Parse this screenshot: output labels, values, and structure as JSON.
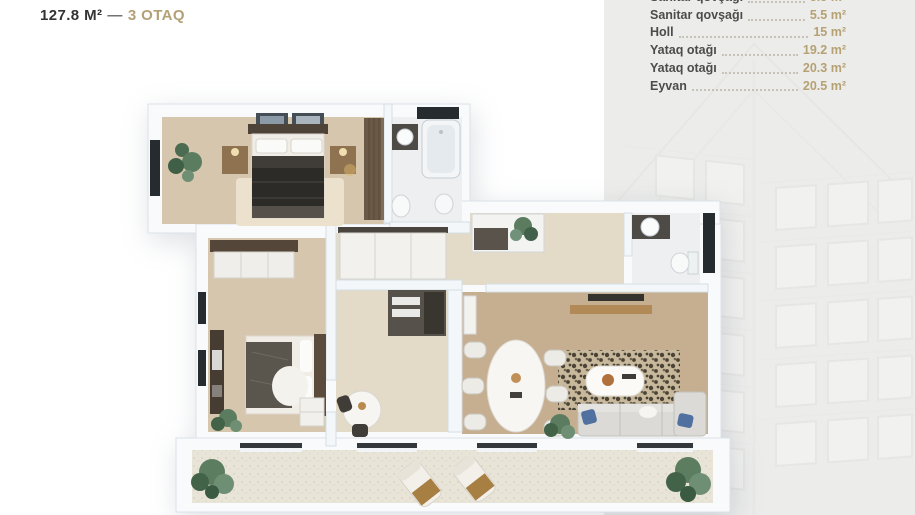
{
  "header": {
    "area": "127.8 M²",
    "separator": "—",
    "rooms": "3 OTAQ"
  },
  "room_list": {
    "rows": [
      {
        "label": "Sanitar qovşağı",
        "value": "5.5 m²",
        "truncated": true
      },
      {
        "label": "Sanitar qovşağı",
        "value": "5.5 m²"
      },
      {
        "label": "Holl",
        "value": "15 m²"
      },
      {
        "label": "Yataq otağı",
        "value": "19.2 m²"
      },
      {
        "label": "Yataq otağı",
        "value": "20.3 m²"
      },
      {
        "label": "Eyvan",
        "value": "20.5 m²"
      }
    ]
  },
  "colors": {
    "accent_gold": "#b3a077",
    "text_dark": "#333333",
    "list_label": "#4c4c4c",
    "panel_bg": "#ececeb",
    "wall_white": "#f8fafc",
    "floor_bedroom": "#d7c6ae",
    "floor_hall": "#e3dac8",
    "floor_living": "#c6ae90",
    "floor_bath": "#edeff0",
    "floor_balcony": "#e9e4d8",
    "window_dark": "#262b30"
  },
  "floor_plan": {
    "view": "3d-top-down-apartment-render",
    "rooms": [
      {
        "id": "bedroom-1",
        "furniture": [
          "double-bed",
          "nightstands",
          "wardrobe",
          "plant",
          "wall-art"
        ]
      },
      {
        "id": "bathroom-1",
        "furniture": [
          "bathtub",
          "sink",
          "toilet",
          "bidet"
        ]
      },
      {
        "id": "entry-hall",
        "furniture": [
          "closets",
          "plant"
        ]
      },
      {
        "id": "bedroom-2",
        "furniture": [
          "bed",
          "wardrobe",
          "tv-bench",
          "dresser",
          "plant"
        ]
      },
      {
        "id": "kitchen-dining",
        "furniture": [
          "kitchen-unit",
          "round-table",
          "chairs"
        ]
      },
      {
        "id": "living-room",
        "furniture": [
          "oval-dining-table",
          "chairs",
          "sofa",
          "coffee-table",
          "rug",
          "tv",
          "plant"
        ]
      },
      {
        "id": "bathroom-2",
        "furniture": [
          "sink",
          "toilet"
        ]
      },
      {
        "id": "balcony",
        "furniture": [
          "lounge-chairs",
          "plants"
        ]
      }
    ]
  }
}
